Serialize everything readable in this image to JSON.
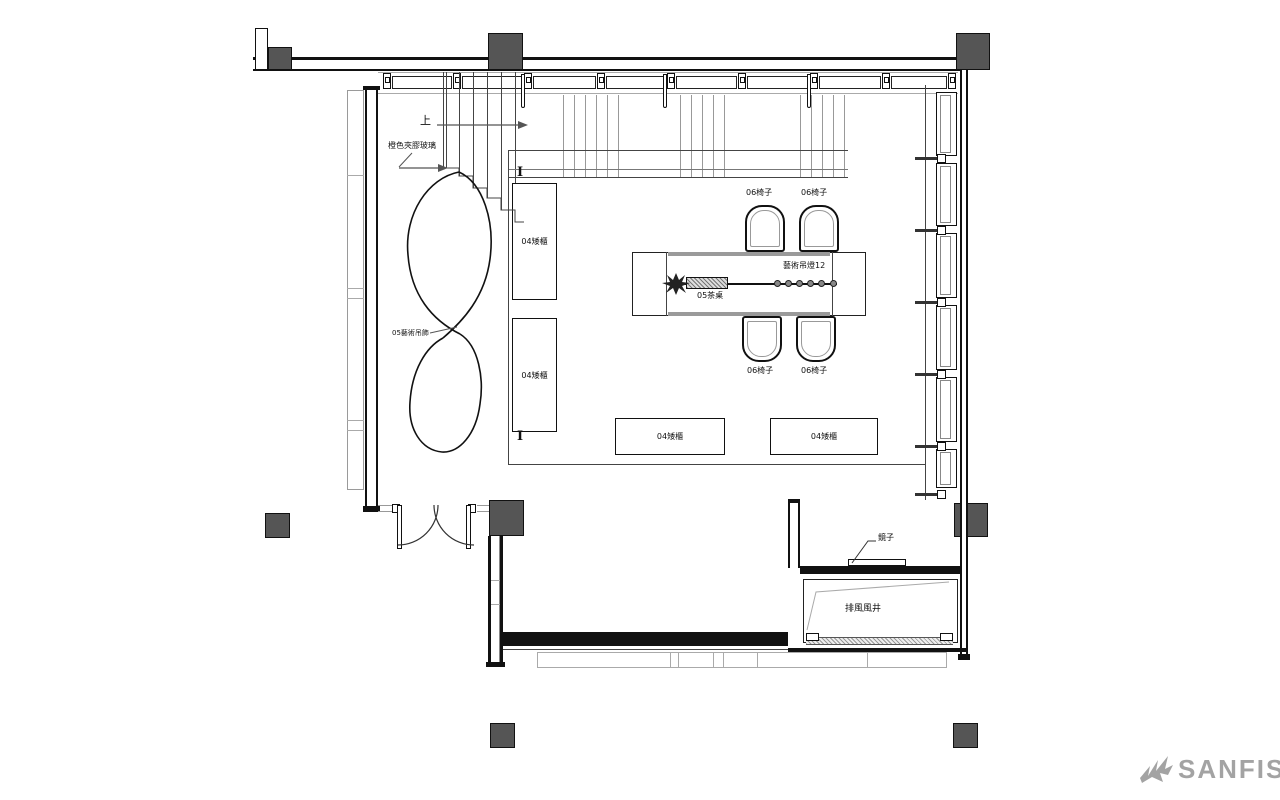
{
  "plan": {
    "annotations": {
      "up": "上",
      "glass_note": "橙色夾膠玻璃",
      "hanging_art_note": "05藝術吊飾",
      "pendant_lights_note": "藝術吊燈12",
      "tea_table_label": "05茶桌",
      "mirror_label": "鏡子",
      "exhaust_shaft_label": "排風風井",
      "section_marker": "I"
    },
    "furniture": {
      "tall_cabinets": [
        {
          "label": "04矮櫃"
        },
        {
          "label": "04矮櫃"
        }
      ],
      "low_cabinets": [
        {
          "label": "04矮櫃"
        },
        {
          "label": "04矮櫃"
        }
      ],
      "chairs": [
        {
          "label": "06椅子"
        },
        {
          "label": "06椅子"
        },
        {
          "label": "06椅子"
        },
        {
          "label": "06椅子"
        }
      ],
      "pendant_light_count": 6
    }
  },
  "watermark": {
    "brand": "SANFISH"
  },
  "colors": {
    "wall": "#111111",
    "column": "#555555",
    "shell": "#9a9a9a",
    "annotation": "#111111",
    "watermark": "#a3a3a3"
  }
}
